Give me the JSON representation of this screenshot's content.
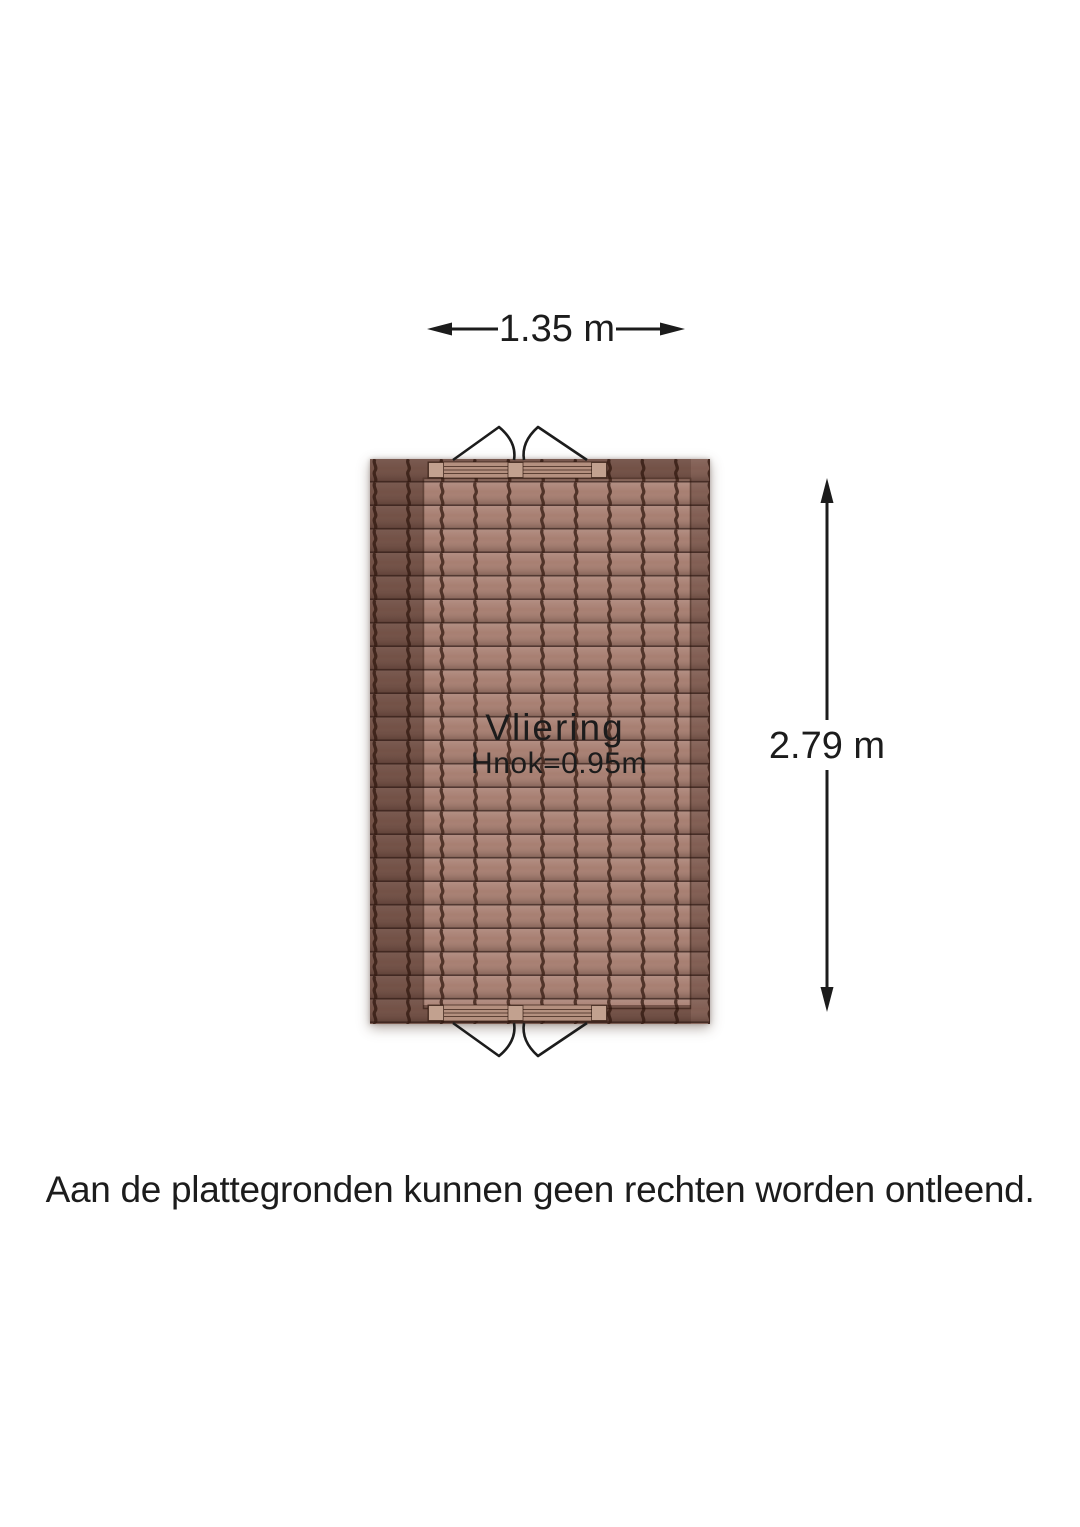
{
  "floorplan": {
    "room": {
      "label": "Vliering",
      "ridge_height_label": "Hnok=0.95m"
    },
    "dimensions": {
      "width_label": "1.35 m",
      "height_label": "2.79 m"
    },
    "disclaimer": "Aan de plattegronden kunnen geen rechten worden ontleend."
  },
  "colors": {
    "tile-base": "#a87f72",
    "tile-groove": "#3b2017",
    "roof-shade": "#2a140c",
    "window-band": "#b4907f",
    "window-post": "#c2a18f",
    "line": "#1c1c1c",
    "bg": "#ffffff"
  }
}
